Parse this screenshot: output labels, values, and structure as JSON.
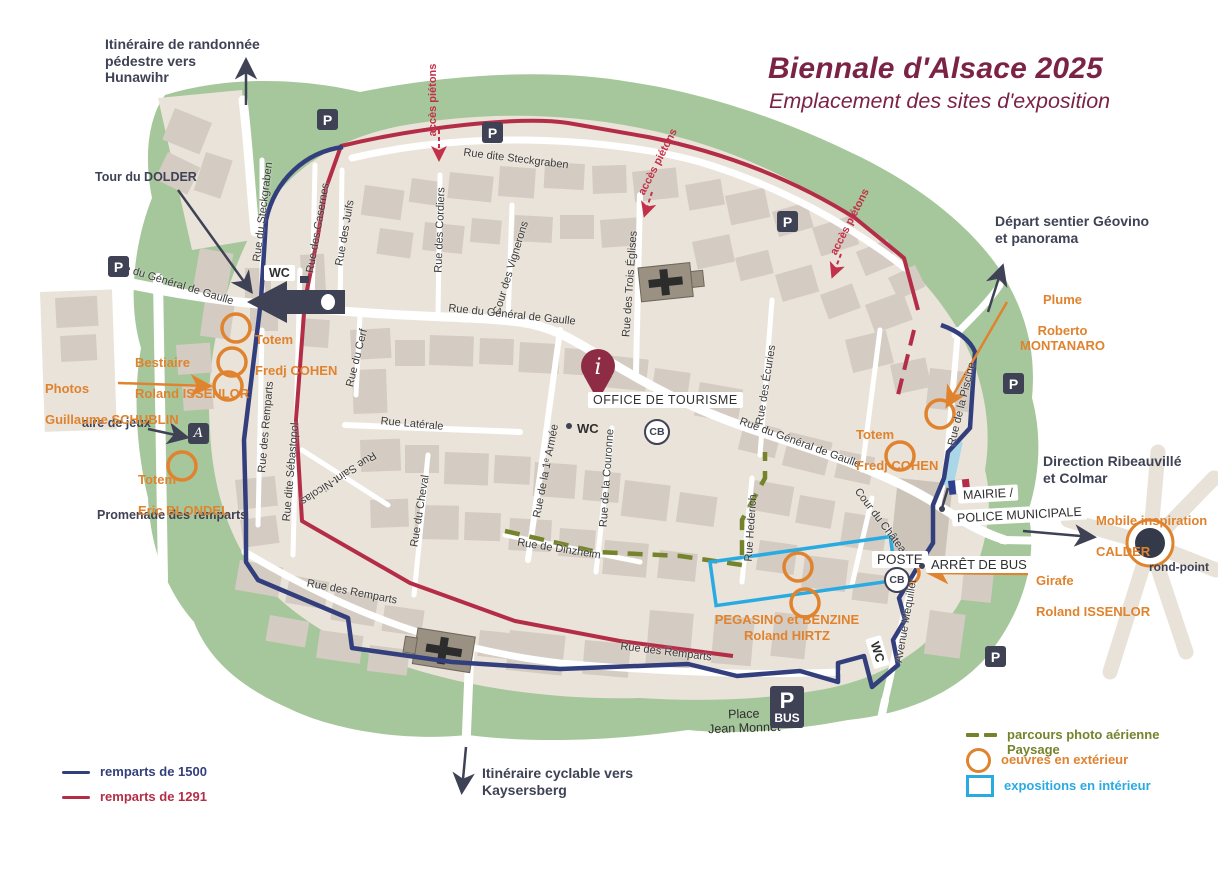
{
  "header": {
    "title": "Biennale d'Alsace 2025",
    "subtitle": "Emplacement des sites d'exposition"
  },
  "directions": {
    "hunawihr": "Itinéraire de randonnée\npédestre vers\nHunawihr",
    "dolder": "Tour du DOLDER",
    "geovino": "Départ sentier Géovino\net panorama",
    "ribeauville": "Direction Ribeauvillé\net Colmar",
    "kaysersberg": "Itinéraire cyclable vers\nKaysersberg",
    "aire_de_jeux": "aire de jeux",
    "promenade": "Promenade des remparts",
    "place_jean_monnet": "Place\nJean Monnet",
    "rond_point": "rond-point"
  },
  "streets": [
    "Rue dite Steckgraben",
    "Rue du Steckgraben",
    "Rue des Casernes",
    "Rue des Juifs",
    "Rue des Cordiers",
    "Cour des Vignerons",
    "Rue des Trois Églises",
    "Rue du Général de Gaulle",
    "Rue du Général de Gaulle",
    "Rue du Général de Gaulle",
    "Rue du Cerf",
    "Rue Latérale",
    "Rue de la 1ᵉ Armée",
    "Rue de la Couronne",
    "Rue des Écuries",
    "Rue Hederich",
    "Rue Saint-Nicolas",
    "Rue dite Sébastopol",
    "Rue des Remparts",
    "Rue du Cheval",
    "Rue de Dinzheim",
    "Rue des Remparts",
    "Rue des Remparts",
    "Cour du Château",
    "Avenue Méquillet",
    "Rue de la Piscine"
  ],
  "acces_pietons": "accès piétons",
  "pois": {
    "office": "OFFICE DE TOURISME",
    "mairie_line1": "MAIRIE /",
    "mairie_line2": "POLICE MUNICIPALE",
    "poste": "POSTE",
    "arret_bus": "ARRÊT DE BUS",
    "wc": "WC",
    "cb": "CB",
    "parking": "P",
    "bus": "BUS",
    "playground": "A",
    "info": "i"
  },
  "artworks": [
    {
      "work": "Totem",
      "artist": "Fredj COHEN"
    },
    {
      "work": "Bestiaire",
      "artist": "Roland ISSENLOR"
    },
    {
      "work": "Photos",
      "artist": "Guillaume SCHUBLIN"
    },
    {
      "work": "Totem",
      "artist": "Eric BLONDEL"
    },
    {
      "work": "Plume",
      "artist": "Roberto MONTANARO"
    },
    {
      "work": "Totem",
      "artist": "Fredj COHEN"
    },
    {
      "work": "Girafe",
      "artist": "Roland ISSENLOR"
    },
    {
      "work": "PEGASINO et BENZINE",
      "artist": "Roland HIRTZ"
    },
    {
      "work": "Mobile inspiration",
      "artist": "CALDER"
    }
  ],
  "legend": {
    "ramparts_1500": "remparts de 1500",
    "ramparts_1291": "remparts de 1291",
    "parcours": "parcours photo aérienne\nPaysage",
    "oeuvres": "oeuvres en extérieur",
    "expositions": "expositions en intérieur"
  },
  "colors": {
    "maroon": "#7b2346",
    "dark": "#3e4254",
    "green": "#a6c79b",
    "beige": "#eae3d9",
    "building": "#d4ccc2",
    "blue_rampart": "#333f7d",
    "red_rampart": "#b42d47",
    "orange": "#e0832f",
    "cyan": "#29abe2",
    "olive": "#75832c",
    "pool_blue": "#a9d7e8"
  }
}
